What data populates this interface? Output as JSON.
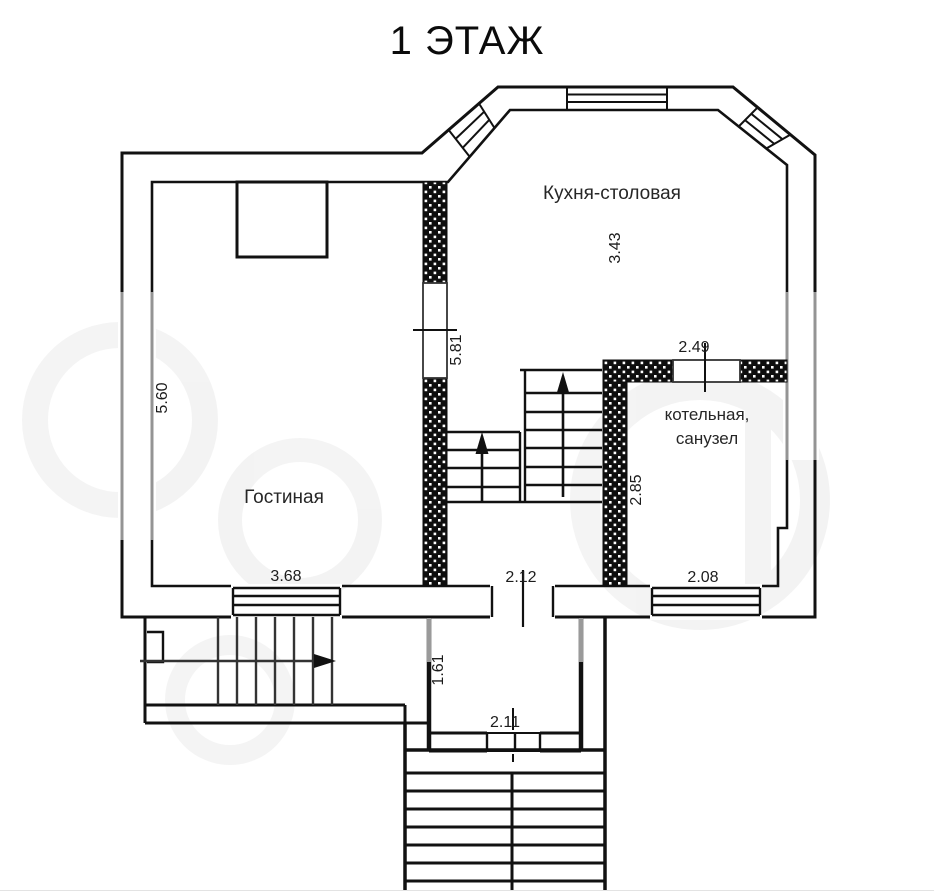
{
  "title": "1 ЭТАЖ",
  "floor_plan": {
    "rooms": {
      "kitchen_dining": {
        "label": "Кухня-столовая",
        "dims": {
          "depth": "3.43"
        }
      },
      "living_room": {
        "label": "Гостиная",
        "dims": {
          "height": "5.60",
          "width": "3.68"
        }
      },
      "boiler_bathroom": {
        "label_line1": "котельная,",
        "label_line2": "санузел",
        "dims": {
          "entry_wall": "2.49",
          "height": "2.85",
          "width": "2.08"
        }
      },
      "stair_hall": {
        "dims": {
          "width": "2.12",
          "partition": "5.81"
        }
      },
      "entry_porch": {
        "dims": {
          "depth": "1.61",
          "width": "2.11"
        }
      }
    }
  }
}
